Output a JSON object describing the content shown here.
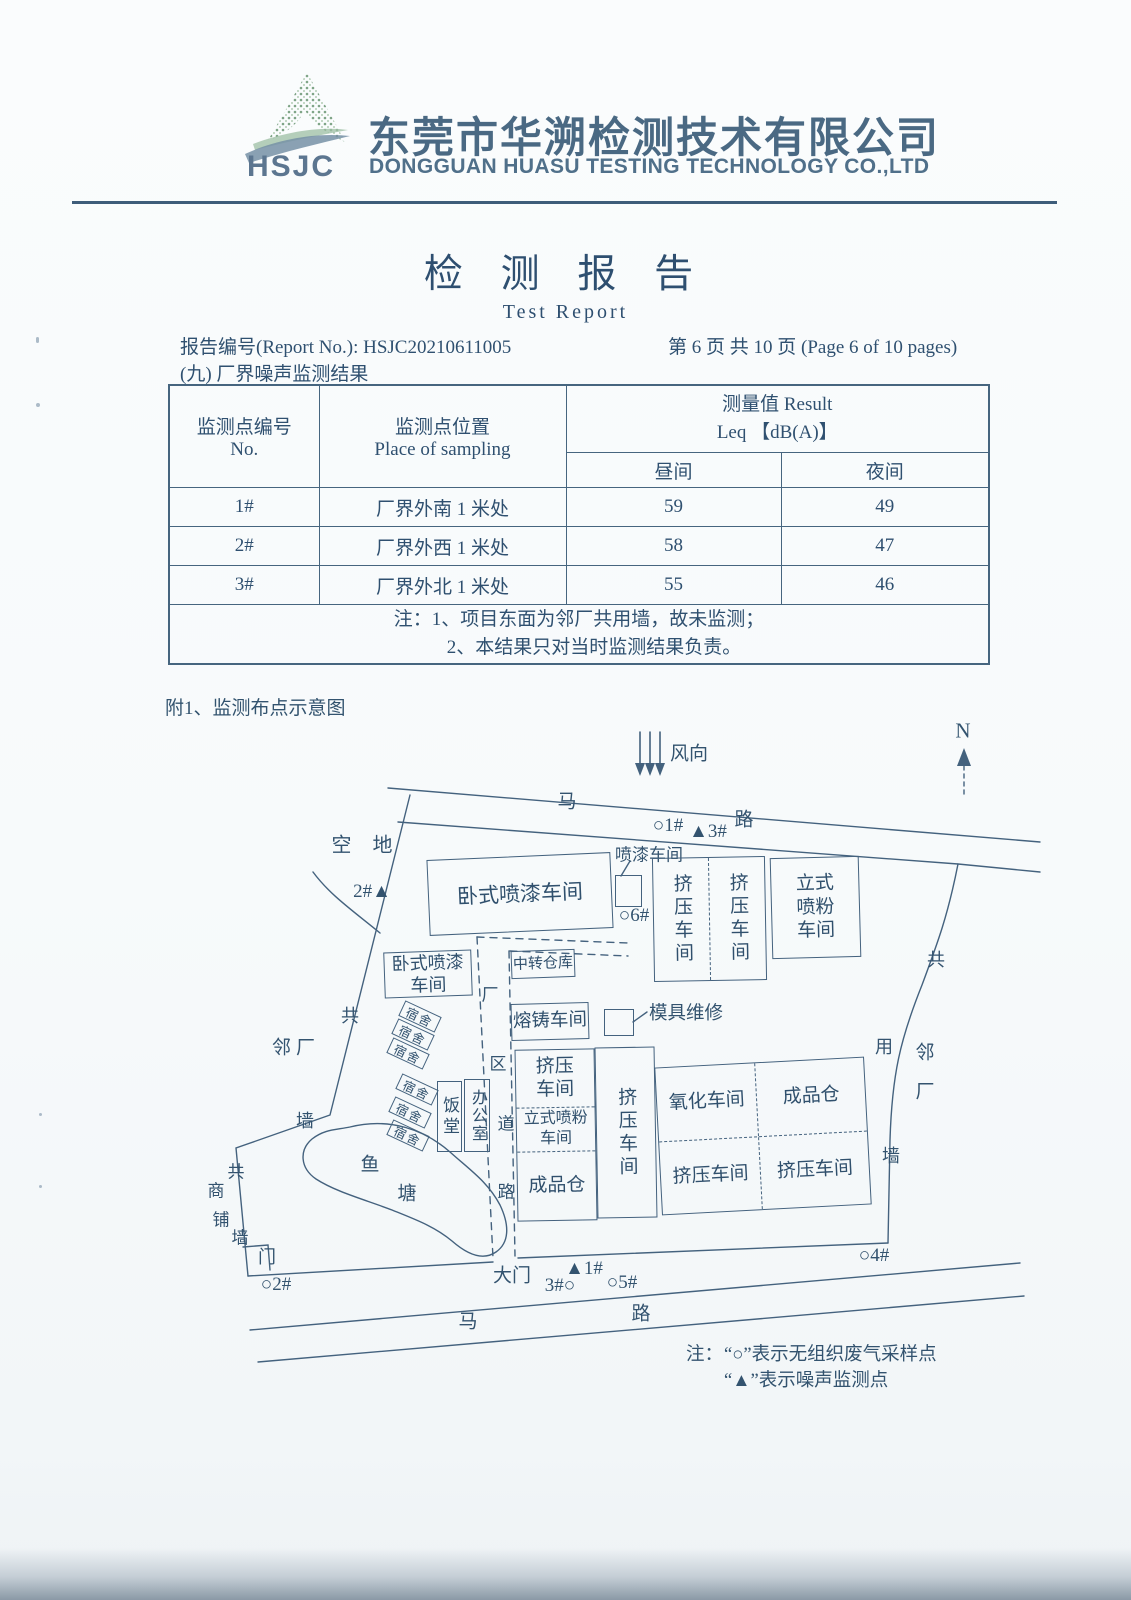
{
  "header": {
    "logo_abbr": "HSJC",
    "company_cn": "东莞市华溯检测技术有限公司",
    "company_en": "DONGGUAN HUASU TESTING TECHNOLOGY CO.,LTD"
  },
  "title": {
    "cn": "检 测 报 告",
    "en": "Test Report"
  },
  "meta": {
    "report_no": "报告编号(Report No.): HSJC20210611005",
    "page_info": "第 6 页 共 10 页  (Page 6 of 10 pages)",
    "section": "(九) 厂界噪声监测结果"
  },
  "table": {
    "headers": {
      "no_cn": "监测点编号",
      "no_en": "No.",
      "place_cn": "监测点位置",
      "place_en": "Place of sampling",
      "result_cn": "测量值 Result",
      "result_unit": "Leq 【dB(A)】",
      "day": "昼间",
      "night": "夜间"
    },
    "rows": [
      {
        "no": "1#",
        "place": "厂界外南 1 米处",
        "day": "59",
        "night": "49"
      },
      {
        "no": "2#",
        "place": "厂界外西 1 米处",
        "day": "58",
        "night": "47"
      },
      {
        "no": "3#",
        "place": "厂界外北 1 米处",
        "day": "55",
        "night": "46"
      }
    ],
    "notes": [
      "注：1、项目东面为邻厂共用墙，故未监测；",
      "2、本结果只对当时监测结果负责。"
    ]
  },
  "diagram": {
    "caption": "附1、监测布点示意图",
    "compass_n": "N",
    "wind_label": "风向",
    "top_road": {
      "ma": "马",
      "lu": "路"
    },
    "bottom_road": {
      "ma": "马",
      "lu": "路"
    },
    "points": {
      "top_circle_1": "○1#",
      "top_tri_3": "▲3#",
      "left_2": "2#▲",
      "circle_6": "○6#",
      "gate_tri_1": "▲1#",
      "gate_circle_3": "3#○",
      "gate_circle_5": "○5#",
      "right_circle_4": "○4#",
      "bottom_circle_2": "○2#"
    },
    "areas": {
      "empty_lot": "空 地",
      "neighbor_left": "邻厂",
      "wall_left_1": "共",
      "wall_left_2": "墙",
      "shop_1": "共",
      "shop_2": "商",
      "shop_3": "铺",
      "shop_4": "墙",
      "door": "门",
      "pond_1": "鱼",
      "pond_2": "塘",
      "gate": "大门",
      "road_v_1": "厂",
      "road_v_2": "区",
      "road_v_3": "道",
      "road_v_4": "路",
      "wall_right_1": "共",
      "wall_right_2": "用",
      "wall_right_3": "墙",
      "neighbor_right_1": "邻",
      "neighbor_right_2": "厂"
    },
    "buildings": {
      "paint_h_main": "卧式喷漆车间",
      "paint_small": "喷漆车间",
      "extrude_a": "挤压车间",
      "extrude_b": "挤压车间",
      "powder_v": [
        "立式",
        "喷粉",
        "车间"
      ],
      "paint_h_2": [
        "卧式喷漆",
        "车间"
      ],
      "warehouse": "中转仓库",
      "melting": "熔铸车间",
      "mold": "模具维修",
      "dorm": "宿舍",
      "canteen": "饭堂",
      "office": "办公室",
      "blk_extrude": [
        "挤压",
        "车间"
      ],
      "blk_powder": [
        "立式喷粉",
        "车间"
      ],
      "blk_store": "成品仓",
      "extrude_mid": "挤压车间",
      "oxidation": "氧化车间",
      "store_right": "成品仓",
      "extrude_c": "挤压车间",
      "extrude_d": "挤压车间"
    },
    "legend": {
      "prefix": "注：",
      "line1": "“○”表示无组织废气采样点",
      "line2": "“▲”表示噪声监测点"
    }
  }
}
